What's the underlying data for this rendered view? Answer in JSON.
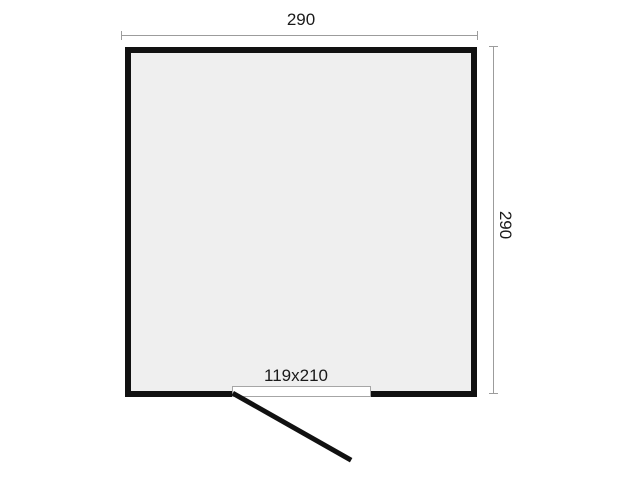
{
  "floor_plan": {
    "type": "room-floor-plan",
    "dimensions": {
      "width_label": "290",
      "depth_label": "290"
    },
    "door": {
      "size_label": "119x210"
    },
    "colors": {
      "background": "#ffffff",
      "room_fill": "#efefef",
      "wall": "#111111",
      "dimension_line": "#9c9c9c",
      "label_text": "#1a1a1a"
    }
  }
}
